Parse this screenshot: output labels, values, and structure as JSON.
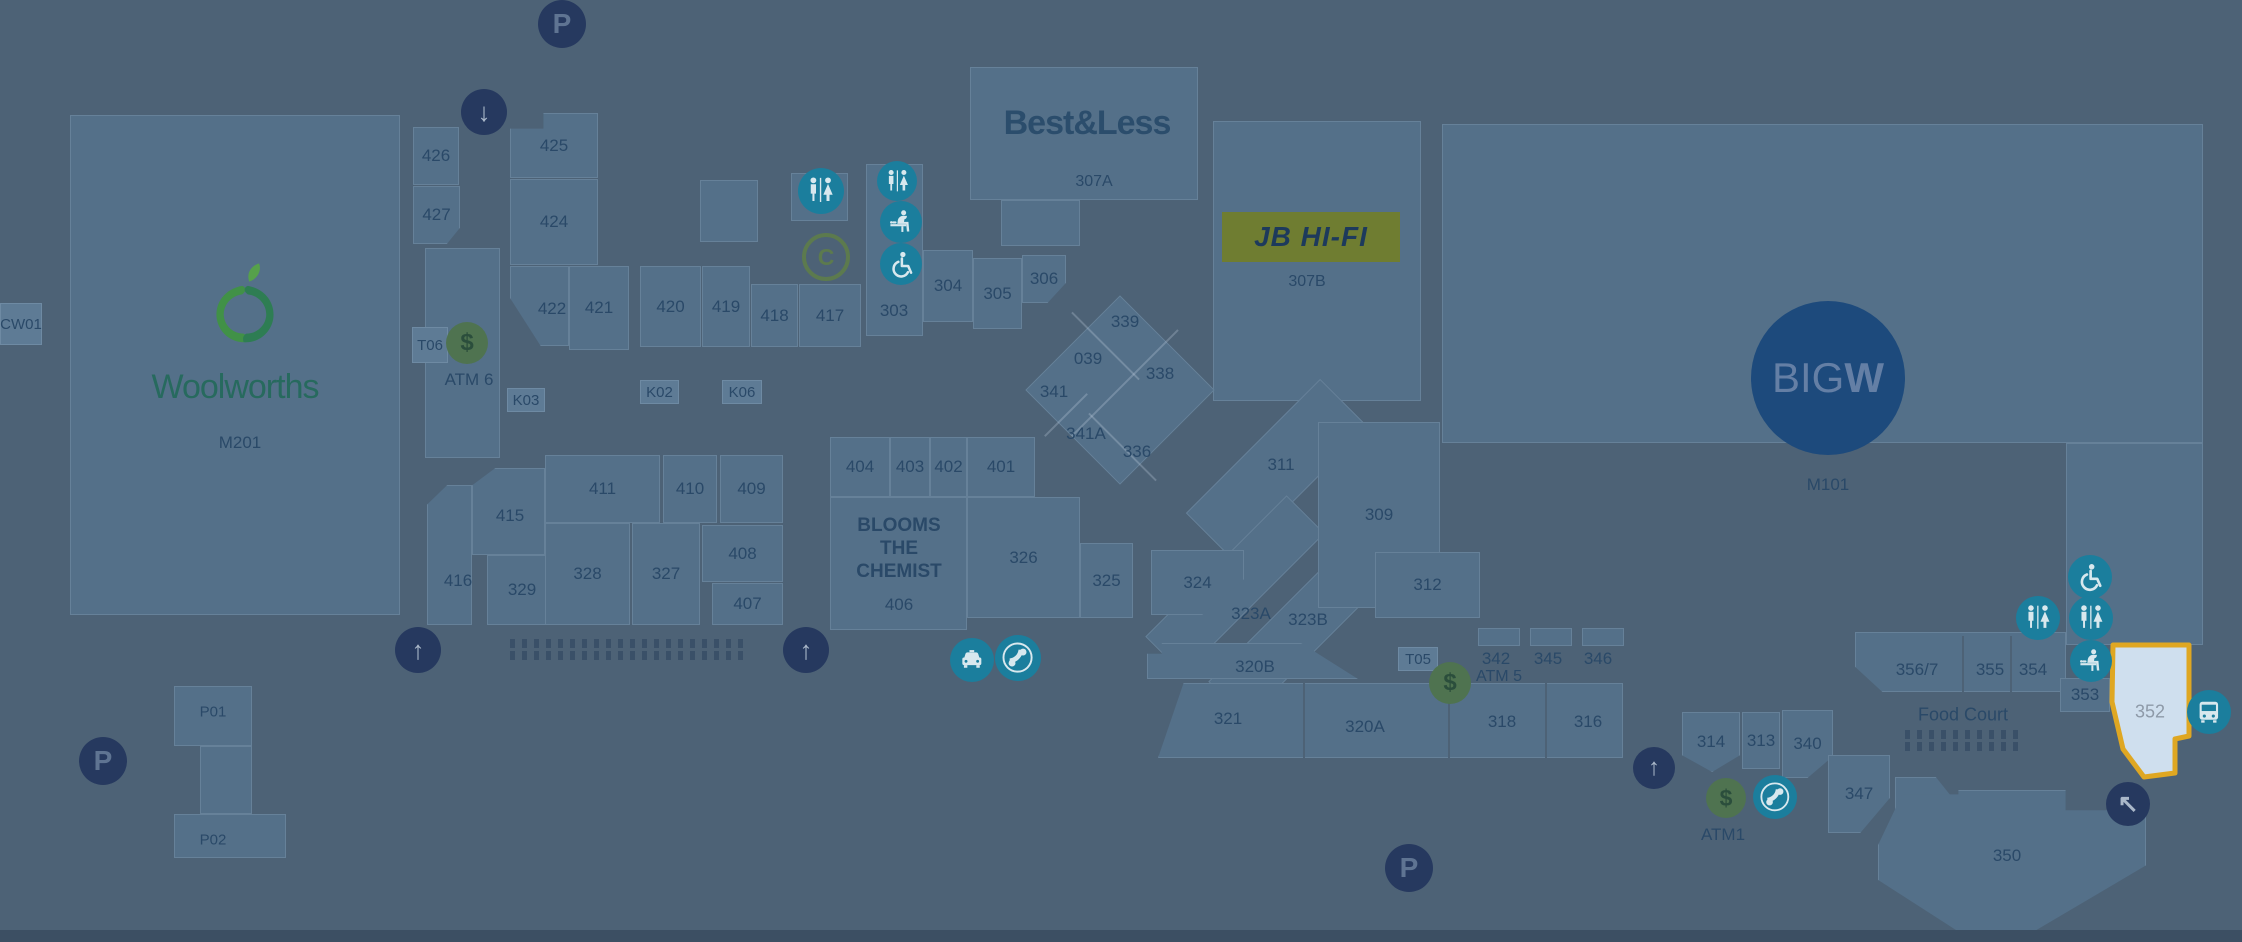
{
  "map": {
    "colors": {
      "background": "#4d6276",
      "store": "#547089",
      "kiosk": "#5e7b95",
      "label": "#2a4968",
      "outline": "rgba(200,218,235,0.16)",
      "navy_circle": "#26395f",
      "navy_glyph_p": "#5f7492",
      "navy_glyph_arrow": "#aab8c9",
      "teal": "#1b7e9d",
      "teal_glyph": "#d8e8ee",
      "green": "#4f7350",
      "green_glyph": "#2b4e3c",
      "c_ring": "#5c7a4e",
      "jb_bg": "#6f7d31",
      "jb_text": "#1d3a5c",
      "bigw_bg": "#1d4a7c",
      "bigw_text": "#647fa5",
      "woolworths_text": "#276a5e",
      "bestless_text": "#2b4d6c",
      "highlight_fill": "#cfdfee",
      "highlight_stroke": "#dfa722",
      "highlight_label": "#8e9aa8",
      "bottom_band": "#3c4f63",
      "stall": "#3a5068"
    },
    "anchors": {
      "woolworths": {
        "name": "Woolworths",
        "code": "M201"
      },
      "bestless": {
        "name": "Best&Less",
        "code": "307A"
      },
      "jbhifi": {
        "name": "JB HI-FI",
        "code": "307B"
      },
      "bigw": {
        "big": "BIG",
        "w": "W",
        "code": "M101"
      },
      "blooms": {
        "lines": [
          "BLOOMS",
          "THE",
          "CHEMIST"
        ],
        "code": "406"
      }
    },
    "stores": [
      {
        "label": "426",
        "x": 413,
        "y": 127,
        "w": 46,
        "h": 58
      },
      {
        "label": "427",
        "x": 413,
        "y": 186,
        "w": 47,
        "h": 58,
        "clip": "polygon(0 0,100% 0,100% 72%,72% 100%,0 100%)"
      },
      {
        "label": "425",
        "x": 510,
        "y": 113,
        "w": 88,
        "h": 65,
        "clip": "polygon(0 24%,38% 24%,38% 0,100% 0,100% 100%,0 100%)"
      },
      {
        "label": "424",
        "x": 510,
        "y": 179,
        "w": 88,
        "h": 86
      },
      {
        "id": "area-422",
        "x": 510,
        "y": 266,
        "w": 59,
        "h": 80,
        "clip": "polygon(0 0,100% 0,100% 100%,52% 100%,0 40%)"
      },
      {
        "label": "421",
        "x": 569,
        "y": 266,
        "w": 60,
        "h": 84
      },
      {
        "label": "420",
        "x": 640,
        "y": 266,
        "w": 61,
        "h": 81
      },
      {
        "label": "419",
        "x": 702,
        "y": 266,
        "w": 48,
        "h": 81
      },
      {
        "label": "418",
        "x": 751,
        "y": 284,
        "w": 47,
        "h": 63
      },
      {
        "label": "417",
        "x": 799,
        "y": 284,
        "w": 62,
        "h": 63
      },
      {
        "id": "box-a",
        "x": 700,
        "y": 180,
        "w": 58,
        "h": 62
      },
      {
        "id": "wc-block",
        "x": 791,
        "y": 173,
        "w": 57,
        "h": 48
      },
      {
        "id": "strip-303",
        "x": 866,
        "y": 164,
        "w": 57,
        "h": 172
      },
      {
        "label": "304",
        "x": 923,
        "y": 250,
        "w": 50,
        "h": 72
      },
      {
        "label": "305",
        "x": 973,
        "y": 258,
        "w": 49,
        "h": 71
      },
      {
        "label": "306",
        "x": 1022,
        "y": 255,
        "w": 44,
        "h": 48,
        "clip": "polygon(0 0,100% 0,100% 58%,58% 100%,0 100%)"
      },
      {
        "id": "woolworths-block",
        "x": 70,
        "y": 115,
        "w": 330,
        "h": 500
      },
      {
        "id": "corridor-strip",
        "x": 425,
        "y": 248,
        "w": 75,
        "h": 210
      },
      {
        "id": "bestless-block",
        "x": 970,
        "y": 67,
        "w": 228,
        "h": 133
      },
      {
        "id": "bestless-tab",
        "x": 1001,
        "y": 200,
        "w": 79,
        "h": 46
      },
      {
        "id": "jb-block",
        "x": 1213,
        "y": 121,
        "w": 208,
        "h": 280
      },
      {
        "id": "bigw-block",
        "x": 1442,
        "y": 124,
        "w": 761,
        "h": 319
      },
      {
        "id": "right-block",
        "x": 2066,
        "y": 443,
        "w": 137,
        "h": 202
      },
      {
        "id": "diamond-cluster",
        "x": 1053,
        "y": 323,
        "w": 134,
        "h": 134,
        "rot": 45
      },
      {
        "id": "band-311",
        "x": 1243,
        "y": 375,
        "w": 68,
        "h": 190,
        "rot": 45
      },
      {
        "id": "band-323a",
        "x": 1208,
        "y": 485,
        "w": 54,
        "h": 200,
        "rot": 45
      },
      {
        "id": "band-323b",
        "x": 1271,
        "y": 530,
        "w": 54,
        "h": 200,
        "rot": 45
      },
      {
        "label": "309",
        "x": 1318,
        "y": 422,
        "w": 122,
        "h": 186
      },
      {
        "label": "312",
        "x": 1375,
        "y": 552,
        "w": 105,
        "h": 66
      },
      {
        "label": "326",
        "x": 967,
        "y": 497,
        "w": 113,
        "h": 121
      },
      {
        "label": "325",
        "x": 1080,
        "y": 543,
        "w": 53,
        "h": 75
      },
      {
        "id": "blooms-block",
        "x": 830,
        "y": 497,
        "w": 137,
        "h": 133
      },
      {
        "label": "404",
        "x": 830,
        "y": 437,
        "w": 60,
        "h": 60
      },
      {
        "label": "403",
        "x": 890,
        "y": 437,
        "w": 40,
        "h": 60
      },
      {
        "label": "402",
        "x": 930,
        "y": 437,
        "w": 37,
        "h": 60
      },
      {
        "label": "401",
        "x": 967,
        "y": 437,
        "w": 68,
        "h": 60
      },
      {
        "label": "324",
        "x": 1151,
        "y": 550,
        "w": 93,
        "h": 65,
        "clip": "polygon(0 0,100% 0,100% 45%,55% 100%,0 100%)"
      },
      {
        "id": "area-416",
        "x": 427,
        "y": 485,
        "w": 45,
        "h": 140,
        "clip": "polygon(0 14%,45% 0,100% 0,100% 100%,0 100%)"
      },
      {
        "id": "area-415",
        "x": 472,
        "y": 468,
        "w": 73,
        "h": 87,
        "clip": "polygon(0 20%,32% 0,100% 0,100% 100%,0 100%)"
      },
      {
        "label": "411",
        "x": 545,
        "y": 455,
        "w": 115,
        "h": 68
      },
      {
        "label": "410",
        "x": 663,
        "y": 455,
        "w": 54,
        "h": 68
      },
      {
        "label": "409",
        "x": 720,
        "y": 455,
        "w": 63,
        "h": 68
      },
      {
        "label": "329",
        "x": 487,
        "y": 555,
        "w": 70,
        "h": 70
      },
      {
        "label": "328",
        "x": 545,
        "y": 523,
        "w": 85,
        "h": 102
      },
      {
        "label": "327",
        "x": 632,
        "y": 523,
        "w": 68,
        "h": 102
      },
      {
        "label": "408",
        "x": 702,
        "y": 525,
        "w": 81,
        "h": 57
      },
      {
        "label": "407",
        "x": 712,
        "y": 583,
        "w": 71,
        "h": 42
      },
      {
        "id": "area-320b",
        "x": 1147,
        "y": 643,
        "w": 211,
        "h": 36,
        "clip": "polygon(0 30%,7% 30%,7% 0,73% 0,100% 100%,0 100%)"
      },
      {
        "id": "strip-321",
        "x": 1158,
        "y": 683,
        "w": 465,
        "h": 75,
        "clip": "polygon(5.5% 0,100% 0,100% 100%,0 100%)"
      },
      {
        "id": "mini-342",
        "x": 1478,
        "y": 628,
        "w": 42,
        "h": 18
      },
      {
        "id": "mini-345",
        "x": 1530,
        "y": 628,
        "w": 42,
        "h": 18
      },
      {
        "id": "mini-346",
        "x": 1582,
        "y": 628,
        "w": 42,
        "h": 18
      },
      {
        "id": "foodcourt-strip",
        "x": 1855,
        "y": 632,
        "w": 211,
        "h": 60,
        "clip": "polygon(0 0,100% 0,100% 100%,13% 100%,0 58%)"
      },
      {
        "label": "353",
        "x": 2060,
        "y": 678,
        "w": 50,
        "h": 34
      },
      {
        "label": "314",
        "x": 1682,
        "y": 712,
        "w": 58,
        "h": 60,
        "clip": "polygon(0 0,100% 0,100% 72%,52% 100%,0 72%)"
      },
      {
        "label": "313",
        "x": 1742,
        "y": 712,
        "w": 38,
        "h": 57
      },
      {
        "label": "340",
        "x": 1782,
        "y": 710,
        "w": 51,
        "h": 68,
        "clip": "polygon(0 0,100% 0,100% 68%,50% 100%,0 100%)"
      },
      {
        "label": "347",
        "x": 1828,
        "y": 755,
        "w": 62,
        "h": 78,
        "clip": "polygon(0 0,100% 0,100% 55%,52% 100%,0 100%)"
      },
      {
        "label": "348",
        "x": 1895,
        "y": 777,
        "w": 60,
        "h": 80,
        "clip": "polygon(0 0,68% 0,100% 30%,100% 100%,58% 100%,46% 84%,34% 100%,0 100%)"
      },
      {
        "id": "area-350",
        "x": 1878,
        "y": 790,
        "w": 268,
        "h": 145,
        "clip": "polygon(0 38%,9% 3%,30% 3%,30% 0,70% 0,70% 14%,100% 14%,100% 52%,56% 100%,32% 100%,0 62%)"
      },
      {
        "id": "p-zone-top",
        "x": 174,
        "y": 686,
        "w": 78,
        "h": 60
      },
      {
        "id": "p-zone-stem",
        "x": 200,
        "y": 746,
        "w": 52,
        "h": 68
      },
      {
        "id": "p-zone-bottom",
        "x": 174,
        "y": 814,
        "w": 112,
        "h": 44
      }
    ],
    "kiosks": [
      {
        "label": "T06",
        "x": 412,
        "y": 327,
        "w": 36,
        "h": 36
      },
      {
        "label": "K03",
        "x": 507,
        "y": 388,
        "w": 38,
        "h": 24
      },
      {
        "label": "K02",
        "x": 640,
        "y": 380,
        "w": 39,
        "h": 24
      },
      {
        "label": "K06",
        "x": 722,
        "y": 380,
        "w": 40,
        "h": 24
      },
      {
        "label": "T05",
        "x": 1398,
        "y": 647,
        "w": 40,
        "h": 24
      },
      {
        "label": "CW01",
        "x": 0,
        "y": 303,
        "w": 42,
        "h": 42
      }
    ],
    "area_labels": [
      {
        "t": "422",
        "x": 552,
        "y": 309
      },
      {
        "t": "415",
        "x": 510,
        "y": 516
      },
      {
        "t": "416",
        "x": 458,
        "y": 581
      },
      {
        "t": "303",
        "x": 894,
        "y": 311
      },
      {
        "t": "339",
        "x": 1125,
        "y": 322
      },
      {
        "t": "039",
        "x": 1088,
        "y": 359
      },
      {
        "t": "338",
        "x": 1160,
        "y": 374
      },
      {
        "t": "341",
        "x": 1054,
        "y": 392
      },
      {
        "t": "341A",
        "x": 1086,
        "y": 434
      },
      {
        "t": "336",
        "x": 1137,
        "y": 452
      },
      {
        "t": "311",
        "x": 1281,
        "y": 465
      },
      {
        "t": "323A",
        "x": 1251,
        "y": 614
      },
      {
        "t": "323B",
        "x": 1308,
        "y": 620
      },
      {
        "t": "320B",
        "x": 1255,
        "y": 667
      },
      {
        "t": "321",
        "x": 1228,
        "y": 719
      },
      {
        "t": "320A",
        "x": 1365,
        "y": 727
      },
      {
        "t": "318",
        "x": 1502,
        "y": 722
      },
      {
        "t": "316",
        "x": 1588,
        "y": 722
      },
      {
        "t": "342",
        "x": 1496,
        "y": 659
      },
      {
        "t": "345",
        "x": 1548,
        "y": 659
      },
      {
        "t": "346",
        "x": 1598,
        "y": 659
      },
      {
        "t": "356/7",
        "x": 1917,
        "y": 670
      },
      {
        "t": "355",
        "x": 1990,
        "y": 670
      },
      {
        "t": "354",
        "x": 2033,
        "y": 670
      },
      {
        "t": "350",
        "x": 2007,
        "y": 856
      },
      {
        "t": "406",
        "x": 899,
        "y": 605
      },
      {
        "t": "352",
        "x": 2150,
        "y": 712,
        "c": "#8e9aa8",
        "s": 18
      }
    ],
    "facility_labels": [
      {
        "t": "M201",
        "x": 240,
        "y": 443
      },
      {
        "t": "ATM 6",
        "x": 469,
        "y": 380
      },
      {
        "t": "307A",
        "x": 1094,
        "y": 182,
        "s": 16
      },
      {
        "t": "307B",
        "x": 1307,
        "y": 282,
        "s": 16
      },
      {
        "t": "M101",
        "x": 1828,
        "y": 485
      },
      {
        "t": "ATM 5",
        "x": 1499,
        "y": 677,
        "s": 16
      },
      {
        "t": "ATM1",
        "x": 1723,
        "y": 835
      },
      {
        "t": "Food Court",
        "x": 1963,
        "y": 715,
        "s": 18
      },
      {
        "t": "P01",
        "x": 213,
        "y": 712,
        "s": 15
      },
      {
        "t": "P02",
        "x": 213,
        "y": 840,
        "s": 15
      }
    ],
    "icons": [
      {
        "type": "parking",
        "x": 562,
        "y": 24,
        "r": 24
      },
      {
        "type": "parking",
        "x": 103,
        "y": 761,
        "r": 24
      },
      {
        "type": "parking",
        "x": 1409,
        "y": 868,
        "r": 24
      },
      {
        "type": "arrow-down",
        "x": 484,
        "y": 112,
        "r": 23
      },
      {
        "type": "arrow-up",
        "x": 418,
        "y": 650,
        "r": 23
      },
      {
        "type": "arrow-up",
        "x": 806,
        "y": 650,
        "r": 23
      },
      {
        "type": "arrow-up",
        "x": 1654,
        "y": 768,
        "r": 21
      },
      {
        "type": "arrow-upleft",
        "x": 2128,
        "y": 804,
        "r": 22
      },
      {
        "type": "restroom",
        "x": 821,
        "y": 191,
        "r": 23
      },
      {
        "type": "restroom",
        "x": 897,
        "y": 181,
        "r": 20
      },
      {
        "type": "parents",
        "x": 901,
        "y": 222,
        "r": 21
      },
      {
        "type": "wheelchair",
        "x": 901,
        "y": 264,
        "r": 21
      },
      {
        "type": "c-ring",
        "x": 822,
        "y": 253,
        "r": 20
      },
      {
        "type": "atm",
        "x": 467,
        "y": 343,
        "r": 21
      },
      {
        "type": "atm",
        "x": 1450,
        "y": 683,
        "r": 21
      },
      {
        "type": "atm",
        "x": 1726,
        "y": 798,
        "r": 20
      },
      {
        "type": "taxi",
        "x": 972,
        "y": 660,
        "r": 22
      },
      {
        "type": "phone",
        "x": 1018,
        "y": 658,
        "r": 23
      },
      {
        "type": "phone",
        "x": 1775,
        "y": 797,
        "r": 22
      },
      {
        "type": "bus",
        "x": 2209,
        "y": 712,
        "r": 22
      },
      {
        "type": "wheelchair",
        "x": 2090,
        "y": 577,
        "r": 22
      },
      {
        "type": "restroom",
        "x": 2038,
        "y": 618,
        "r": 22
      },
      {
        "type": "restroom",
        "x": 2091,
        "y": 618,
        "r": 22
      },
      {
        "type": "parents",
        "x": 2091,
        "y": 661,
        "r": 21
      }
    ],
    "icon_glyphs": {
      "parking": "P",
      "atm": "$",
      "c-ring": "C",
      "arrow-down": "↓",
      "arrow-up": "↑",
      "arrow-upleft": "↖"
    },
    "separators": [
      {
        "x": 1303,
        "y": 683,
        "h": 75
      },
      {
        "x": 1448,
        "y": 683,
        "h": 75
      },
      {
        "x": 1545,
        "y": 683,
        "h": 75
      },
      {
        "x": 1962,
        "y": 636,
        "h": 56
      },
      {
        "x": 2010,
        "y": 636,
        "h": 56
      }
    ],
    "diamond_lines": [
      {
        "x": 1105,
        "y": 345,
        "len": 95,
        "rot": 45
      },
      {
        "x": 1125,
        "y": 382,
        "len": 150,
        "rot": -45
      },
      {
        "x": 1122,
        "y": 446,
        "len": 95,
        "rot": 45
      },
      {
        "x": 1066,
        "y": 414,
        "len": 60,
        "rot": -45
      }
    ],
    "stall_patterns": [
      {
        "x": 510,
        "y": 636,
        "w": 233
      },
      {
        "x": 1905,
        "y": 727,
        "w": 113
      }
    ],
    "highlight": {
      "label": "352",
      "x": 2106,
      "y": 640,
      "w": 90,
      "h": 142,
      "points": "7,5 83,5 83,96 69,99 69,133 38,137 17,109 6,62"
    }
  }
}
